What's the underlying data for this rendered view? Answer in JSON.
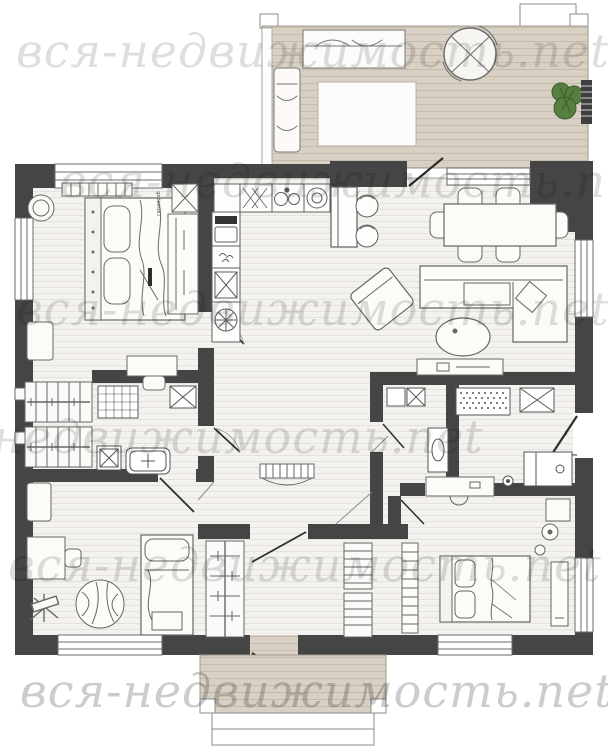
{
  "watermark": {
    "text": "вся-недвижимость.net",
    "color": "#8f8f8f",
    "rows": 6
  },
  "labels": {
    "closet": "гардероб",
    "entrance": "вх"
  },
  "palette": {
    "wall": "#454545",
    "deck": "#d8d0c3",
    "deck_line": "#c4bbac",
    "floor": "#f3f2ee",
    "floor_line": "#e5e2dc",
    "outline": "#666666",
    "furniture_fill": "#fcfbf8",
    "plant": "#567f41",
    "plant_dark": "#3c5c2c",
    "door_leaf": "#2e2e2e",
    "window_frame": "#6b6b6b"
  },
  "furniture_icons": {
    "terrace": [
      "sofa",
      "rug",
      "lounge-chair",
      "parasol-table",
      "plant",
      "bench"
    ],
    "bedroom_top_left": [
      "double-bed",
      "pouf",
      "dresser",
      "wardrobe",
      "nightstand",
      "desk"
    ],
    "kitchen": [
      "counter",
      "dish-rack",
      "sink",
      "hob",
      "oven",
      "appliance-column",
      "island",
      "bar-stools"
    ],
    "living_dining": [
      "dining-table",
      "dining-chairs",
      "corner-sofa",
      "coffee-table",
      "tv-console",
      "armchair"
    ],
    "bathroom": [
      "shower",
      "washing-machine",
      "bathtub",
      "cabinet"
    ],
    "closet": [
      "wardrobe-units"
    ],
    "hallway": [
      "console-table"
    ],
    "entry": [
      "doormat",
      "cabinet",
      "bench",
      "wash-basin",
      "entrance-door"
    ],
    "bedroom_bottom_left": [
      "single-bed",
      "desk",
      "chair",
      "easel",
      "rug",
      "cabinet"
    ],
    "bedroom_bottom_mid": [
      "wardrobe",
      "shelving"
    ],
    "bedroom_bottom_right": [
      "double-bed",
      "wardrobe",
      "dressing-table",
      "stool",
      "nightstand",
      "lamp",
      "mirror"
    ],
    "porch": [
      "deck",
      "steps"
    ]
  }
}
